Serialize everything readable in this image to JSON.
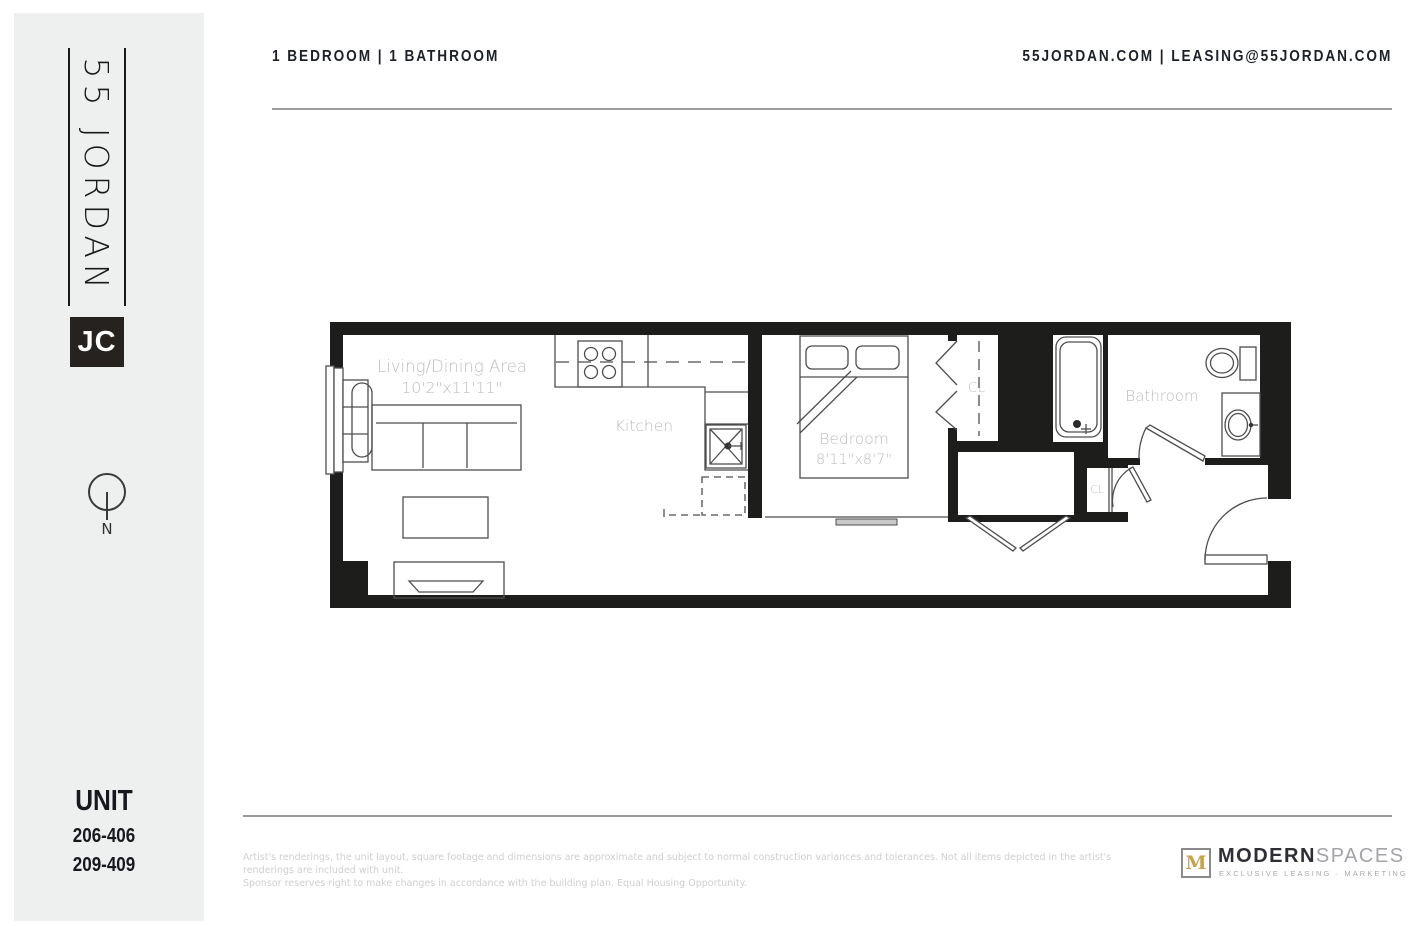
{
  "sidebar": {
    "logo_text": "55 JORDAN",
    "logo_badge": "JC",
    "compass_label": "N",
    "unit_heading": "UNIT",
    "unit_numbers": [
      "206-406",
      "209-409"
    ]
  },
  "header": {
    "left": "1 BEDROOM  |  1 BATHROOM",
    "right": "55JORDAN.COM  |  LEASING@55JORDAN.COM"
  },
  "floorplan": {
    "rooms": {
      "living": {
        "name": "Living/Dining Area",
        "dimensions": "10'2\"x11'11\""
      },
      "kitchen": {
        "name": "Kitchen"
      },
      "bedroom": {
        "name": "Bedroom",
        "dimensions": "8'11\"x8'7\""
      },
      "bathroom": {
        "name": "Bathroom"
      },
      "closet_bedroom": {
        "name": "CL"
      },
      "closet_entry": {
        "name": "CL"
      }
    }
  },
  "footer": {
    "disclaimer_line1": "Artist's renderings, the unit layout, square footage and dimensions are approximate and subject to normal construction variances and tolerances. Not all items depicted in the artist's renderings are included with unit.",
    "disclaimer_line2": "Sponsor reserves right to make changes in accordance with the building plan. Equal Housing Opportunity.",
    "brand": {
      "mark": "M",
      "name_bold": "MODERN",
      "name_light": "SPACES",
      "tagline": "EXCLUSIVE LEASING · MARKETING"
    }
  },
  "colors": {
    "wall": "#1d1d1b",
    "sidebar_background": "#eef0f0",
    "header_text": "#1c2128",
    "label_gray": "#bdbdbd",
    "accent_gold": "#c9a24b",
    "rule_gray": "#9b9b9b"
  }
}
